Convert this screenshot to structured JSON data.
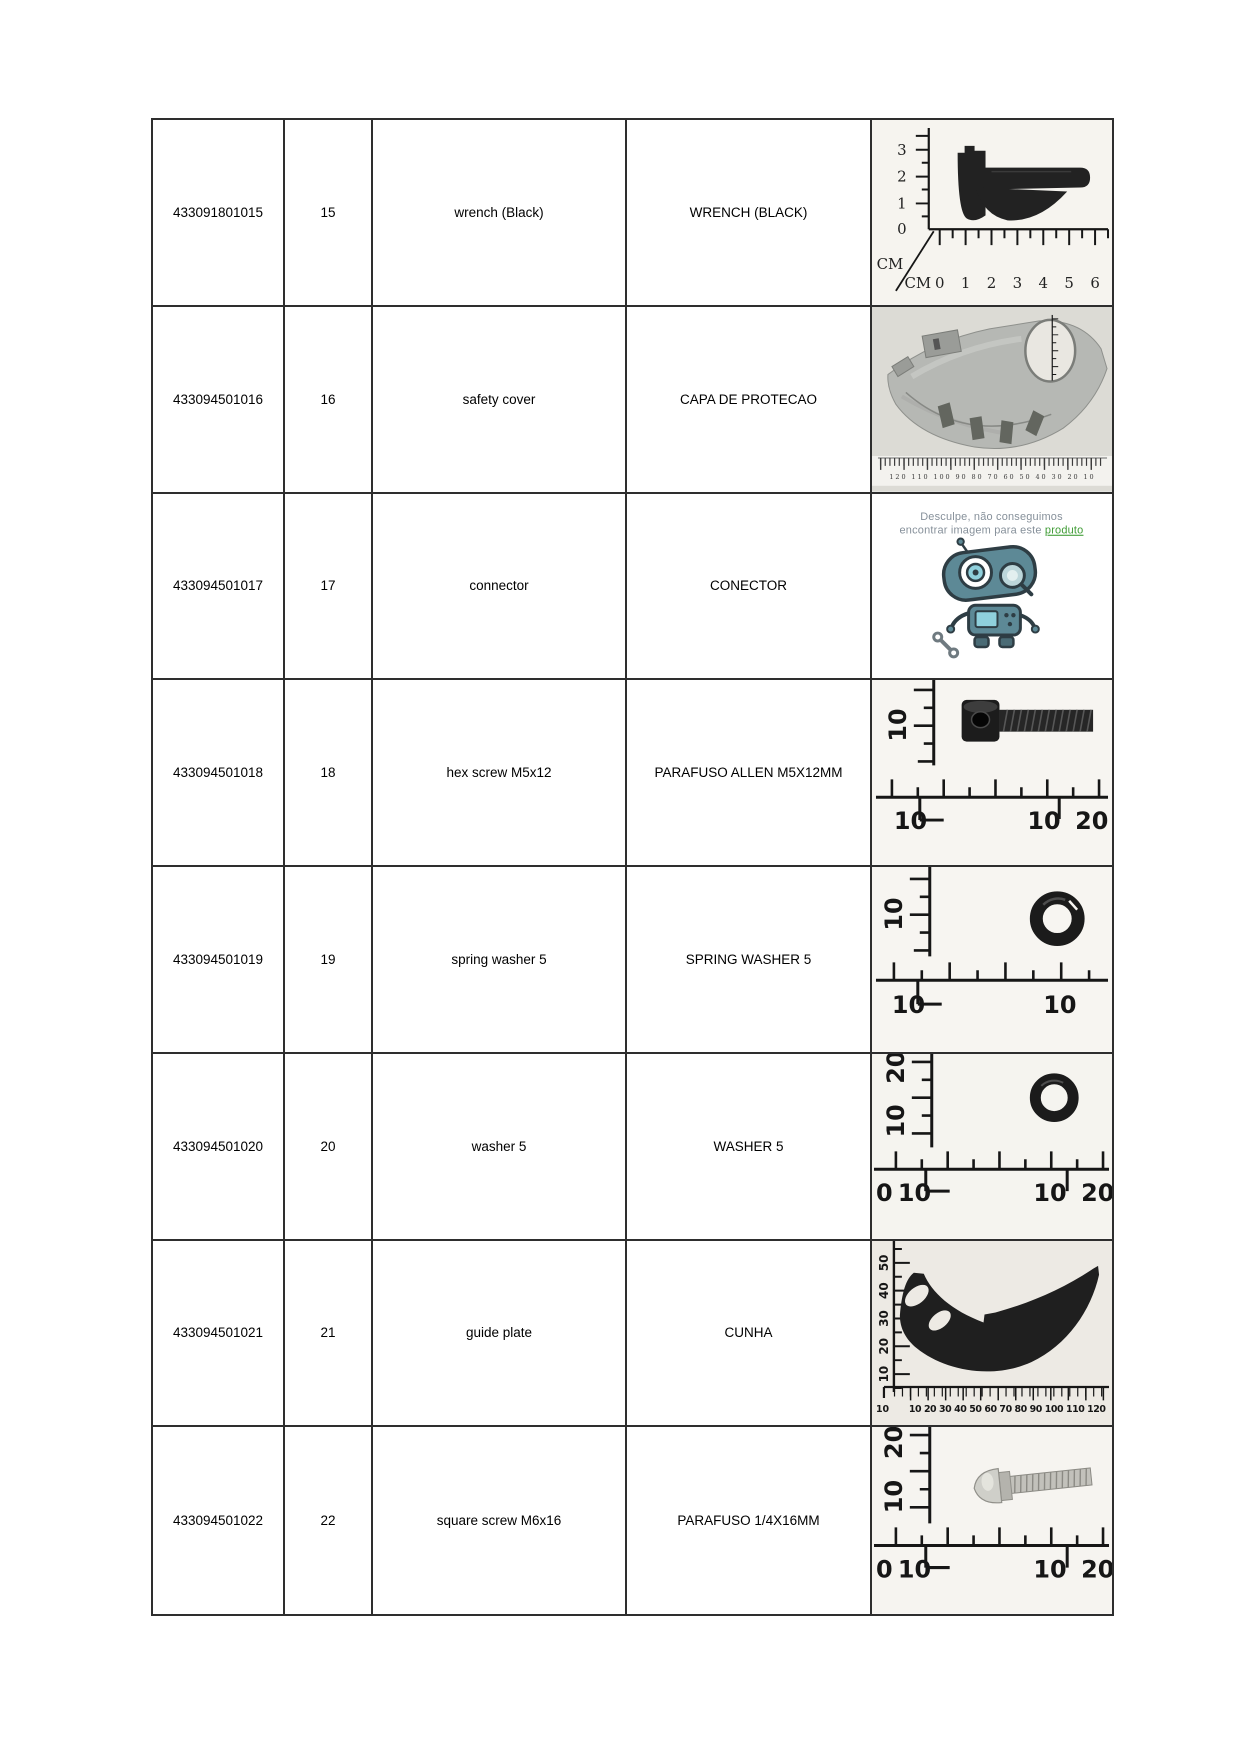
{
  "table": {
    "columns": [
      "part_number",
      "item_no",
      "description_en",
      "description_pt",
      "image"
    ],
    "rows": [
      {
        "part_number": "433091801015",
        "item_no": "15",
        "description_en": "wrench (Black)",
        "description_pt": "WRENCH (BLACK)",
        "image": "wrench-photo"
      },
      {
        "part_number": "433094501016",
        "item_no": "16",
        "description_en": "safety cover",
        "description_pt": "CAPA DE PROTECAO",
        "image": "safety-cover-photo"
      },
      {
        "part_number": "433094501017",
        "item_no": "17",
        "description_en": "connector",
        "description_pt": "CONECTOR",
        "image": "no-image-placeholder"
      },
      {
        "part_number": "433094501018",
        "item_no": "18",
        "description_en": "hex screw M5x12",
        "description_pt": "PARAFUSO ALLEN M5X12MM",
        "image": "hex-screw-photo"
      },
      {
        "part_number": "433094501019",
        "item_no": "19",
        "description_en": "spring washer 5",
        "description_pt": "SPRING WASHER 5",
        "image": "spring-washer-photo"
      },
      {
        "part_number": "433094501020",
        "item_no": "20",
        "description_en": "washer 5",
        "description_pt": "WASHER 5",
        "image": "washer-photo"
      },
      {
        "part_number": "433094501021",
        "item_no": "21",
        "description_en": "guide plate",
        "description_pt": "CUNHA",
        "image": "guide-plate-photo"
      },
      {
        "part_number": "433094501022",
        "item_no": "22",
        "description_en": "square screw M6x16",
        "description_pt": "PARAFUSO 1/4X16MM",
        "image": "square-screw-photo"
      }
    ]
  },
  "photos": {
    "wrench": {
      "v": [
        "3",
        "2",
        "1",
        "0"
      ],
      "cm_v": "CM",
      "cm_h": "CM",
      "h": [
        "0",
        "1",
        "2",
        "3",
        "4",
        "5",
        "6"
      ]
    },
    "safety_cover": {
      "scale": "120 110 100 90 80 70 60 50 40 30 20 10"
    },
    "no_image": {
      "line1": "Desculpe, não conseguimos",
      "line2": "encontrar imagem para este ",
      "link": "produto"
    },
    "hex_screw": {
      "v": "10",
      "bl": "10",
      "br1": "10",
      "br2": "20"
    },
    "spring_washer": {
      "v": "10",
      "bl": "10",
      "br1": "10"
    },
    "washer": {
      "v1": "20",
      "v2": "10",
      "b0": "0",
      "bl": "10",
      "br1": "10",
      "br2": "20"
    },
    "guide_plate": {
      "v": [
        "50",
        "40",
        "30",
        "20",
        "10"
      ],
      "corner": "10",
      "scale": "10 20 30 40 50 60 70 80 90 100 110 120"
    },
    "square_screw": {
      "v1": "20",
      "v2": "10",
      "b0": "0",
      "bl": "10",
      "br1": "10",
      "br2": "20"
    }
  },
  "colors": {
    "table_border": "#2e2e2e",
    "placeholder_link_green": "#3f9c35",
    "robot_teal": "#5d8996",
    "metal_gray": "#b6b8b4"
  }
}
